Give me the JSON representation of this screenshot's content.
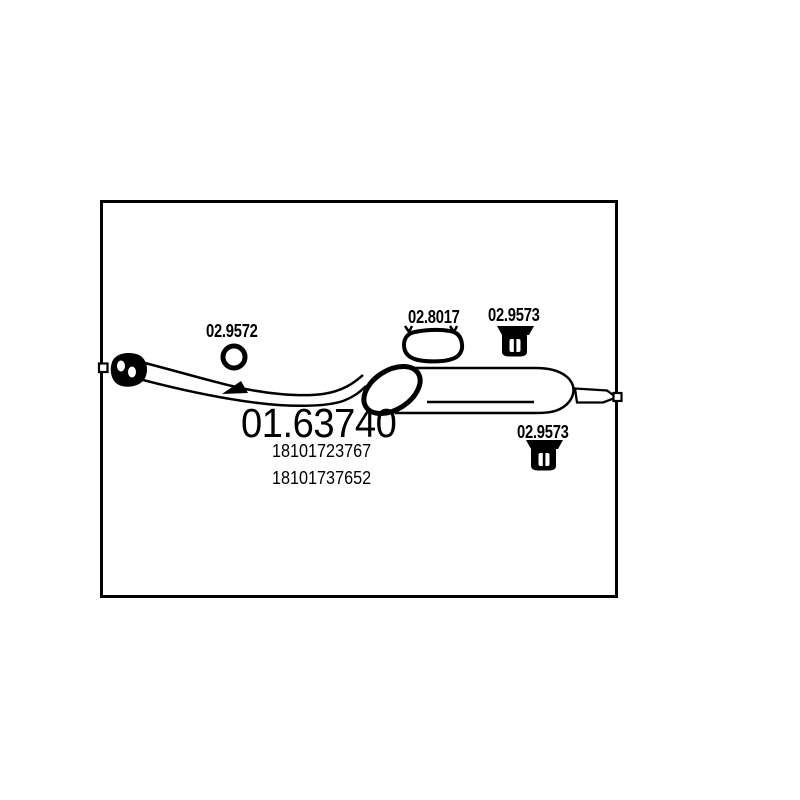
{
  "colors": {
    "ink": "#000000",
    "background": "#ffffff"
  },
  "diagram": {
    "main_part_number": "01.63740",
    "oem_numbers": [
      "18101723767",
      "18101737652"
    ],
    "component_labels": {
      "gasket": "02.9572",
      "clamp": "02.8017",
      "hanger_top": "02.9573",
      "hanger_bottom": "02.9573"
    }
  }
}
